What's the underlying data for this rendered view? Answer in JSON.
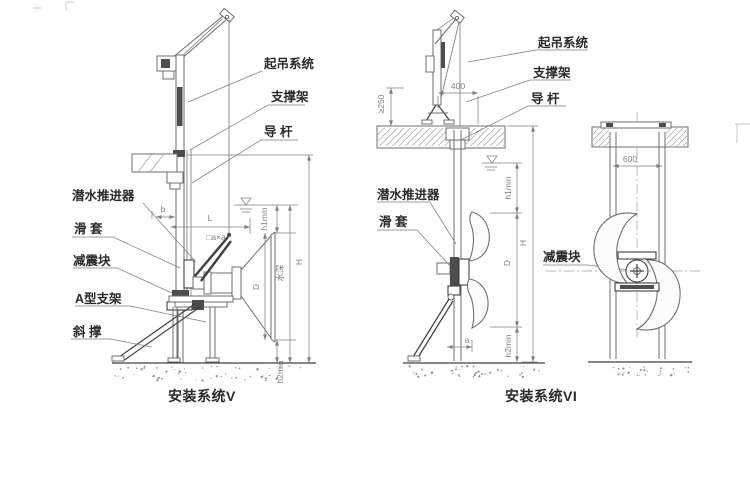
{
  "colors": {
    "ink": "#2a2a2a",
    "line": "#6e6e6e",
    "dark": "#3f3f3f",
    "dim_text": "#7f7f7f",
    "paper": "#ffffff"
  },
  "sysV": {
    "caption": "安装系统V",
    "label_lifting": "起吊系统",
    "label_support": "支撑架",
    "label_guide": "导 杆",
    "label_propeller": "潜水推进器",
    "label_sleeve": "滑 套",
    "label_damper": "减震块",
    "label_abracket": "A型支架",
    "label_brace": "斜 撑",
    "dim_b": "b",
    "dim_L": "L",
    "dim_axa": "□a×a",
    "dim_h1min": "h1min",
    "dim_D": "D",
    "dim_depth": "水深",
    "dim_H": "H",
    "dim_h2min": "h2min"
  },
  "sysVI": {
    "caption": "安装系统VI",
    "label_lifting": "起吊系统",
    "label_support": "支撑架",
    "label_guide": "导 杆",
    "label_propeller": "潜水推进器",
    "label_sleeve": "滑 套",
    "label_damper": "减震块",
    "dim_400": "400",
    "dim_ge250": "≥250",
    "dim_h1min": "h1min",
    "dim_D": "D",
    "dim_H": "H",
    "dim_h2min": "h2min",
    "dim_a": "a",
    "dim_600": "600"
  }
}
